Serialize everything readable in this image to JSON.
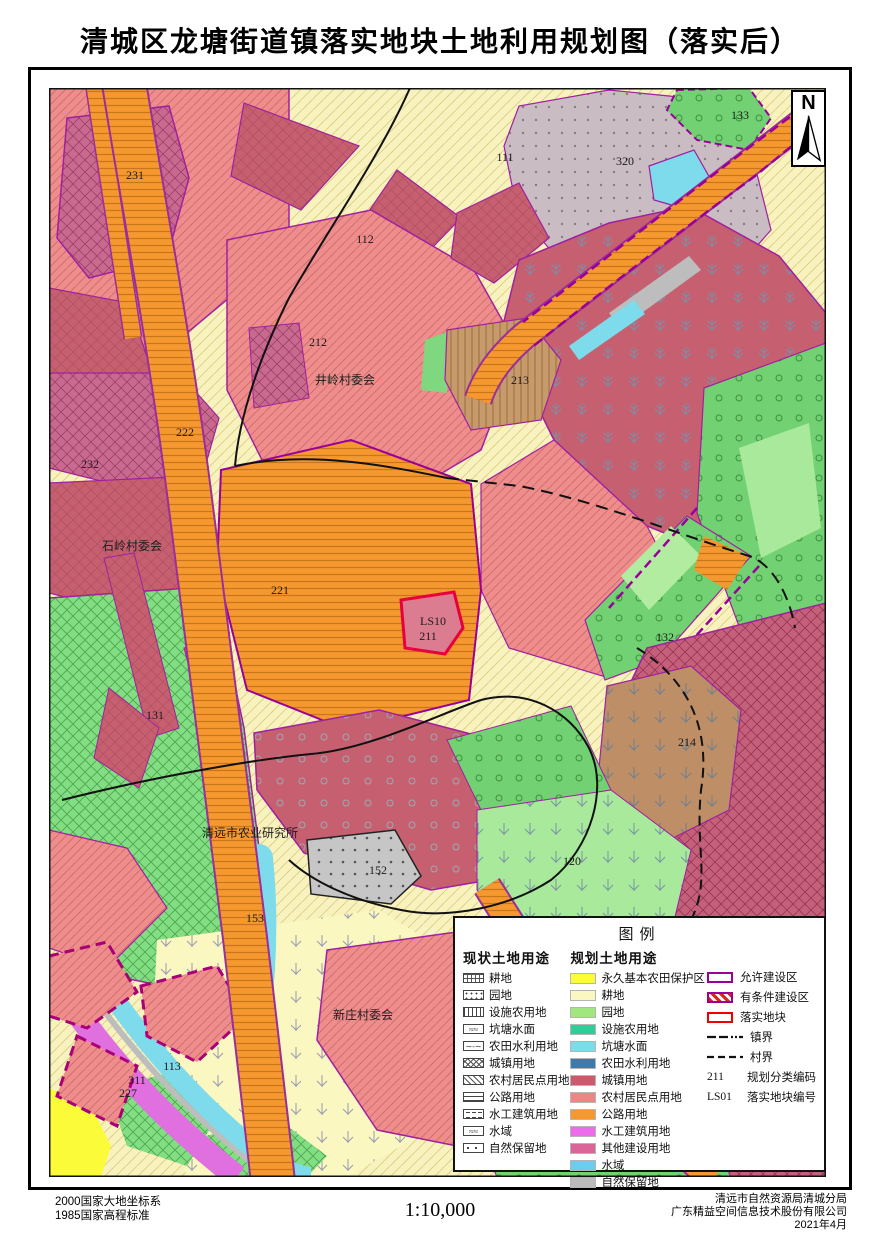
{
  "page": {
    "title": "清城区龙塘街道镇落实地块土地利用规划图（落实后）"
  },
  "north": {
    "label": "N"
  },
  "map": {
    "labels": [
      {
        "text": "231",
        "x": 86,
        "y": 91
      },
      {
        "text": "111",
        "x": 456,
        "y": 73
      },
      {
        "text": "320",
        "x": 576,
        "y": 77
      },
      {
        "text": "133",
        "x": 691,
        "y": 31
      },
      {
        "text": "112",
        "x": 316,
        "y": 155
      },
      {
        "text": "212",
        "x": 269,
        "y": 258
      },
      {
        "text": "井岭村委会",
        "x": 296,
        "y": 296,
        "size": 17
      },
      {
        "text": "213",
        "x": 471,
        "y": 296
      },
      {
        "text": "222",
        "x": 136,
        "y": 348
      },
      {
        "text": "232",
        "x": 41,
        "y": 380
      },
      {
        "text": "石岭村委会",
        "x": 83,
        "y": 462,
        "size": 17
      },
      {
        "text": "221",
        "x": 231,
        "y": 506
      },
      {
        "text": "LS10",
        "x": 384,
        "y": 537,
        "size": 14
      },
      {
        "text": "211",
        "x": 379,
        "y": 552,
        "size": 11
      },
      {
        "text": "132",
        "x": 616,
        "y": 553
      },
      {
        "text": "131",
        "x": 106,
        "y": 631
      },
      {
        "text": "214",
        "x": 638,
        "y": 658
      },
      {
        "text": "清远市农业研究所",
        "x": 201,
        "y": 749,
        "size": 16
      },
      {
        "text": "152",
        "x": 329,
        "y": 786
      },
      {
        "text": "120",
        "x": 523,
        "y": 777
      },
      {
        "text": "153",
        "x": 206,
        "y": 834
      },
      {
        "text": "新庄村委会",
        "x": 314,
        "y": 931,
        "size": 17
      },
      {
        "text": "113",
        "x": 123,
        "y": 982
      },
      {
        "text": "311",
        "x": 88,
        "y": 996
      },
      {
        "text": "227",
        "x": 79,
        "y": 1009
      }
    ]
  },
  "legend": {
    "title": "图例",
    "current": {
      "header": "现状土地用途",
      "items": [
        {
          "label": "耕地",
          "pattern": "plus"
        },
        {
          "label": "园地",
          "pattern": "dots2"
        },
        {
          "label": "设施农用地",
          "pattern": "vbars"
        },
        {
          "label": "坑塘水面",
          "pattern": "waves"
        },
        {
          "label": "农田水利用地",
          "pattern": "wavedash"
        },
        {
          "label": "城镇用地",
          "pattern": "xhatch"
        },
        {
          "label": "农村居民点用地",
          "pattern": "diag"
        },
        {
          "label": "公路用地",
          "pattern": "hlines"
        },
        {
          "label": "水工建筑用地",
          "pattern": "hdash"
        },
        {
          "label": "水域",
          "pattern": "waves"
        },
        {
          "label": "自然保留地",
          "pattern": "dotsparse"
        }
      ]
    },
    "planned": {
      "header": "规划土地用途",
      "items": [
        {
          "label": "永久基本农田保护区",
          "color": "#FBFB3A"
        },
        {
          "label": "耕地",
          "color": "#FAF7C1"
        },
        {
          "label": "园地",
          "color": "#9FE77E"
        },
        {
          "label": "设施农用地",
          "color": "#32CC98"
        },
        {
          "label": "坑塘水面",
          "color": "#7EDBEC"
        },
        {
          "label": "农田水利用地",
          "color": "#3A7CB2"
        },
        {
          "label": "城镇用地",
          "color": "#CC5A6C"
        },
        {
          "label": "农村居民点用地",
          "color": "#F08482"
        },
        {
          "label": "公路用地",
          "color": "#F5982F"
        },
        {
          "label": "水工建筑用地",
          "color": "#EC6CEC"
        },
        {
          "label": "其他建设用地",
          "color": "#DC6598"
        },
        {
          "label": "水域",
          "color": "#6CCBEF"
        },
        {
          "label": "自然保留地",
          "color": "#BCBCBC"
        }
      ]
    },
    "overlay": {
      "items": [
        {
          "label": "允许建设区",
          "type": "box-purple"
        },
        {
          "label": "有条件建设区",
          "type": "box-hatch"
        },
        {
          "label": "落实地块",
          "type": "box-red"
        },
        {
          "label": "镇界",
          "type": "line-town"
        },
        {
          "label": "村界",
          "type": "line-village"
        }
      ],
      "codes": [
        {
          "code": "211",
          "label": "规划分类编码"
        },
        {
          "code": "LS01",
          "label": "落实地块编号"
        }
      ]
    }
  },
  "footer": {
    "left": [
      "2000国家大地坐标系",
      "1985国家高程标准"
    ],
    "scale": "1:10,000",
    "right": [
      "清远市自然资源局清城分局",
      "广东精益空间信息技术股份有限公司",
      "2021年4月"
    ]
  },
  "colors": {
    "allowed_zone": "#990099",
    "conditional_zone": "#DD2222",
    "parcel_outline": "#EE0000",
    "boundary": "#111111"
  }
}
